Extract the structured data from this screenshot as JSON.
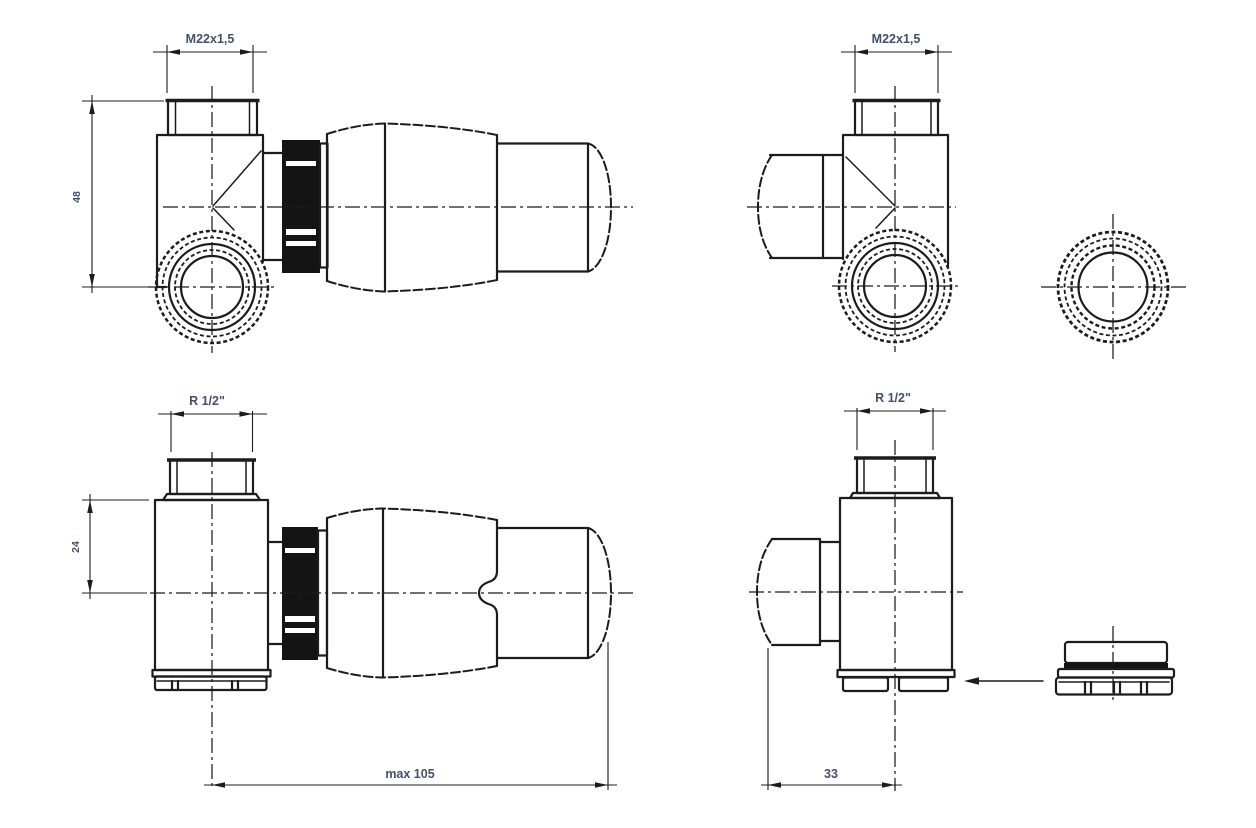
{
  "drawing": {
    "colors": {
      "background": "#ffffff",
      "line": "#1c1c1c",
      "dimension_text": "#42506b",
      "knurled_ring_fill": "#141414"
    },
    "dimensions": {
      "top_left_thread": "M22x1,5",
      "top_left_height": "48",
      "top_right_thread": "M22x1,5",
      "bottom_left_thread": "R 1/2\"",
      "bottom_left_height": "24",
      "bottom_left_length": "max 105",
      "bottom_right_thread": "R 1/2\"",
      "bottom_right_width": "33"
    }
  }
}
